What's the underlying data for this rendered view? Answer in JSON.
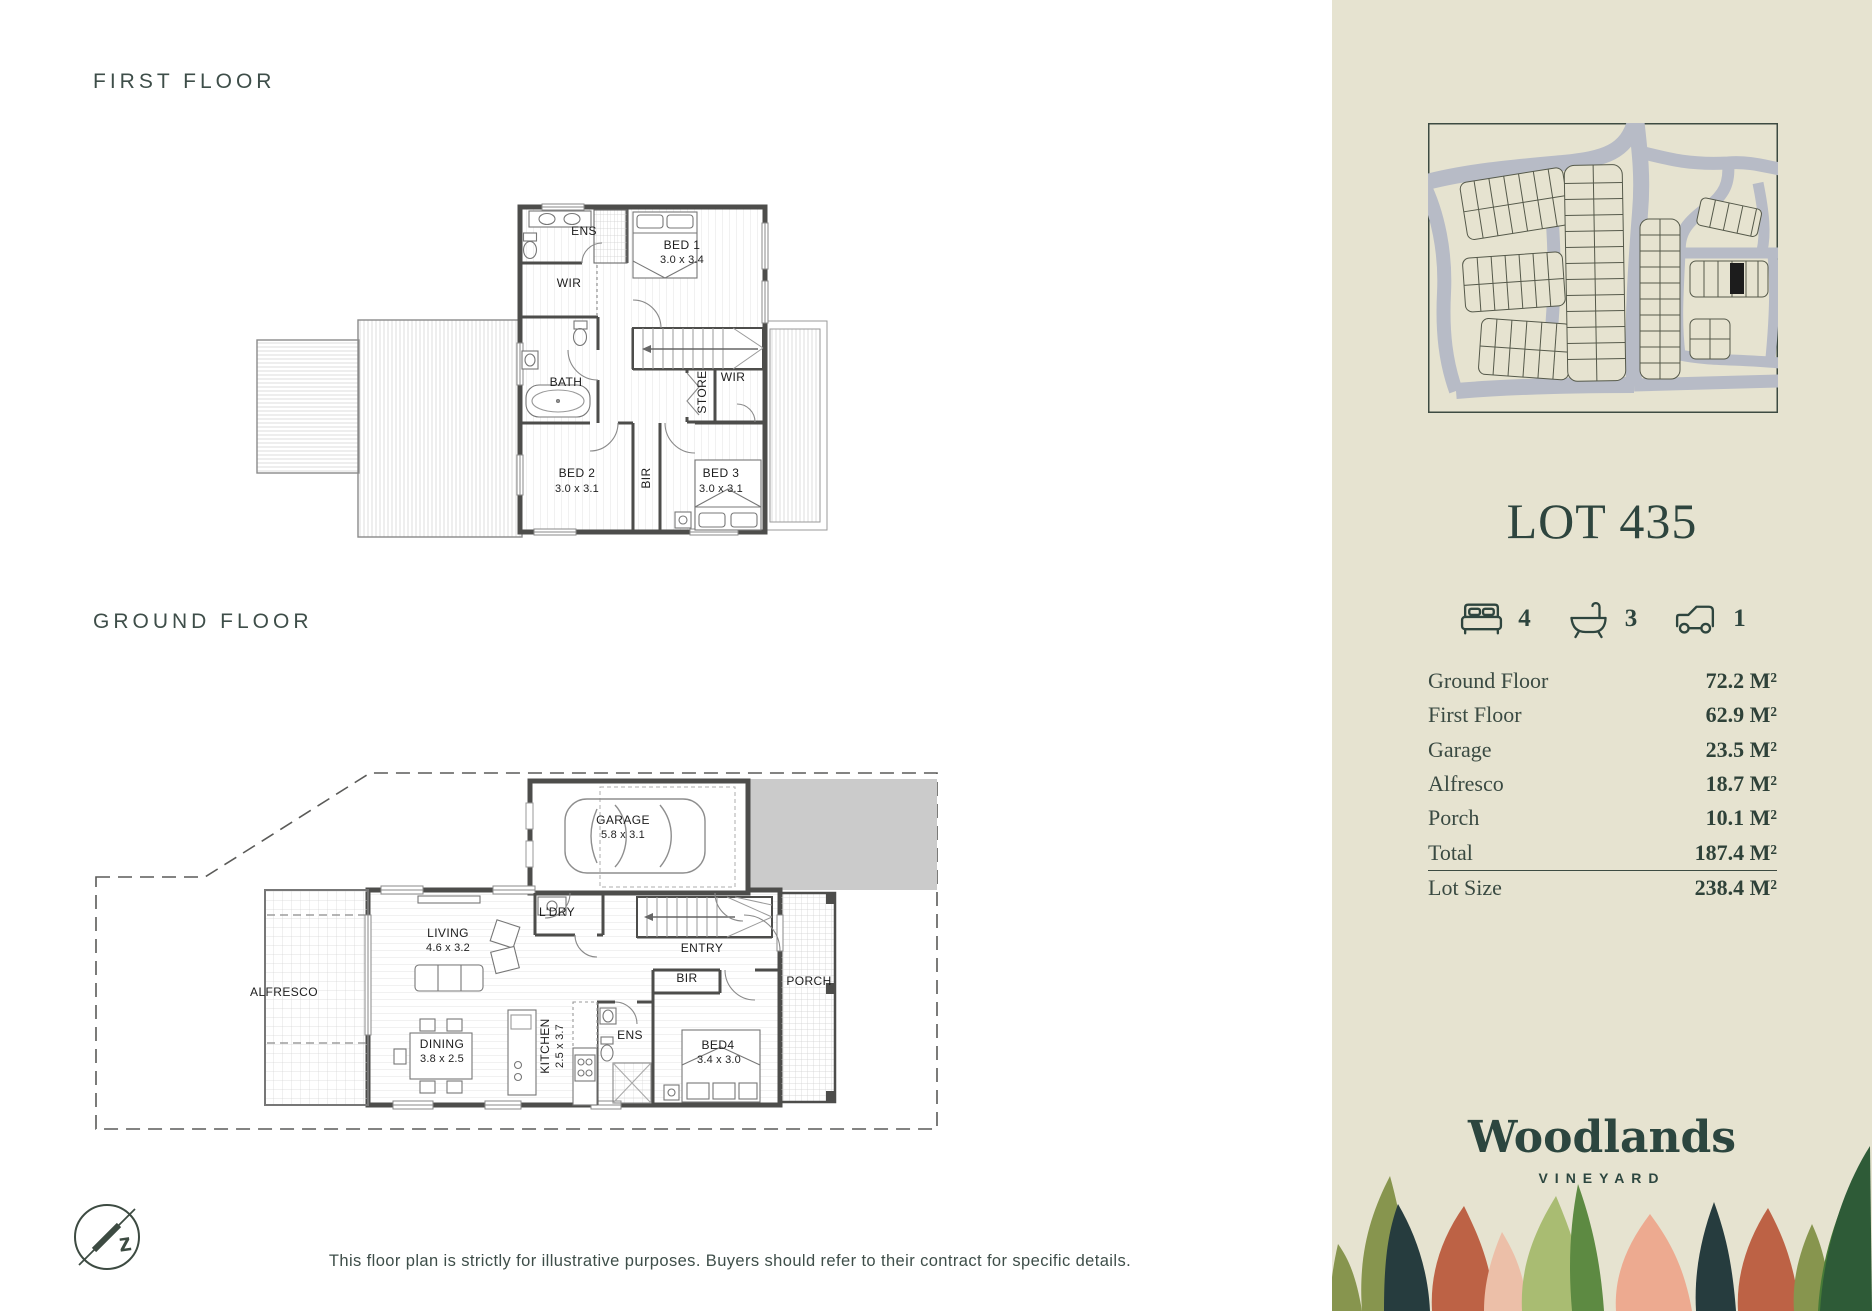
{
  "page": {
    "disclaimer": "This floor plan is strictly for illustrative purposes. Buyers should refer to their contract for specific details.",
    "compass_letter": "z"
  },
  "plans": {
    "first_floor": {
      "heading": "FIRST FLOOR",
      "labels": {
        "ens": "ENS",
        "bed1": "BED 1",
        "bed1_size": "3.0 x 3.4",
        "wir1": "WIR",
        "bath": "BATH",
        "store": "STORE",
        "wir2": "WIR",
        "bed2": "BED 2",
        "bed2_size": "3.0 x 3.1",
        "bir": "BIR",
        "bed3": "BED 3",
        "bed3_size": "3.0 x 3.1"
      }
    },
    "ground_floor": {
      "heading": "GROUND FLOOR",
      "labels": {
        "alfresco": "ALFRESCO",
        "living": "LIVING",
        "living_size": "4.6 x 3.2",
        "dining": "DINING",
        "dining_size": "3.8 x 2.5",
        "garage": "GARAGE",
        "garage_size": "5.8 x 3.1",
        "ldry": "L'DRY",
        "entry": "ENTRY",
        "bir": "BIR",
        "porch": "PORCH",
        "ens": "ENS",
        "kitchen": "KITCHEN",
        "kitchen_size": "2.5 x 3.7",
        "bed4": "BED4",
        "bed4_size": "3.4 x 3.0"
      }
    }
  },
  "sidebar": {
    "lot_title": "LOT 435",
    "stats": [
      {
        "icon": "bed-icon",
        "value": "4"
      },
      {
        "icon": "bath-icon",
        "value": "3"
      },
      {
        "icon": "car-icon",
        "value": "1"
      }
    ],
    "areas": [
      {
        "label": "Ground Floor",
        "value": "72.2 M²"
      },
      {
        "label": "First Floor",
        "value": "62.9 M²"
      },
      {
        "label": "Garage",
        "value": "23.5 M²"
      },
      {
        "label": "Alfresco",
        "value": "18.7 M²"
      },
      {
        "label": "Porch",
        "value": "10.1 M²"
      },
      {
        "label": "Total",
        "value": "187.4 M²"
      },
      {
        "label": "Lot Size",
        "value": "238.4 M²"
      }
    ],
    "brand": {
      "name": "Woodlands",
      "tagline": "VINEYARD"
    },
    "colors": {
      "sidebar_bg": "#e6e3d0",
      "accent_dark": "#2e453e",
      "map_road": "#b7bbc6",
      "highlight_lot": "#1c1c1c"
    }
  }
}
